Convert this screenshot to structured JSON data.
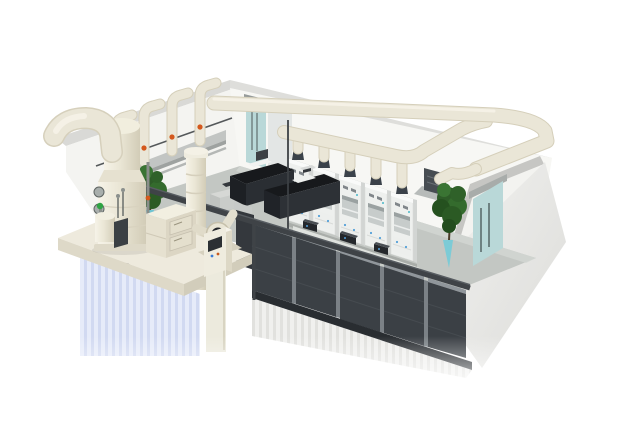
{
  "scene": {
    "kind": "3d-isometric-cutaway-render",
    "subject": "laboratory with fume hoods and exhaust gas treatment system",
    "background": "#ffffff"
  },
  "palette": {
    "duct": "#eae6d7",
    "duct_shadow": "#d5cfba",
    "duct_highlight": "#f7f4ea",
    "wall_face": "#f4f4f1",
    "wall_band": "#d9d9d6",
    "floor": "#c3c7c3",
    "door_glass": "#b9d8d8",
    "cabinet_dark": "#3b4045",
    "cabinet_base": "#292d31",
    "bench_black": "#17191c",
    "counter_grey": "#dfe2de",
    "valve_orange": "#d4581c",
    "handle_blue": "#54a0d8",
    "plant_green": "#2e5c28",
    "vase_teal": "#7ccbd6",
    "equipment_cream": "#eeeadd",
    "vent_dark": "#474d52",
    "beam": "#3f4347",
    "stack_dark": "#3b424a",
    "tray_grey": "#c2c5c3",
    "reflection_blue": "#c9d2ef",
    "exterior": "#ededeb"
  },
  "components": {
    "shell": "laboratory room shell",
    "floor": "laboratory floor",
    "left_wall": "left back wall",
    "back_wall": "back wall",
    "right_wall": "right wall",
    "left_door": "glass door (left)",
    "right_door": "glass door (right)",
    "manifold": "wall pipe manifold with valves",
    "duct_system": "exhaust duct header",
    "fume_hoods": "fume hood row",
    "wall_vent": "wall exhaust vent with canopy",
    "counter": "instrument bench",
    "black_benches": "lab benches",
    "riser": "exhaust riser pipe",
    "plant_left": "potted plant (left)",
    "plant_right": "potted plant (right)",
    "cabinets": "storage cabinet row",
    "beam": "cut front wall beam",
    "platform": "equipment platform",
    "scrubber": "exhaust scrubber tower",
    "tank": "dosing tank",
    "filter_box": "carbon filter unit",
    "blower": "centrifugal exhaust fan",
    "control_panel": "control panel",
    "exterior": "exterior walls"
  }
}
